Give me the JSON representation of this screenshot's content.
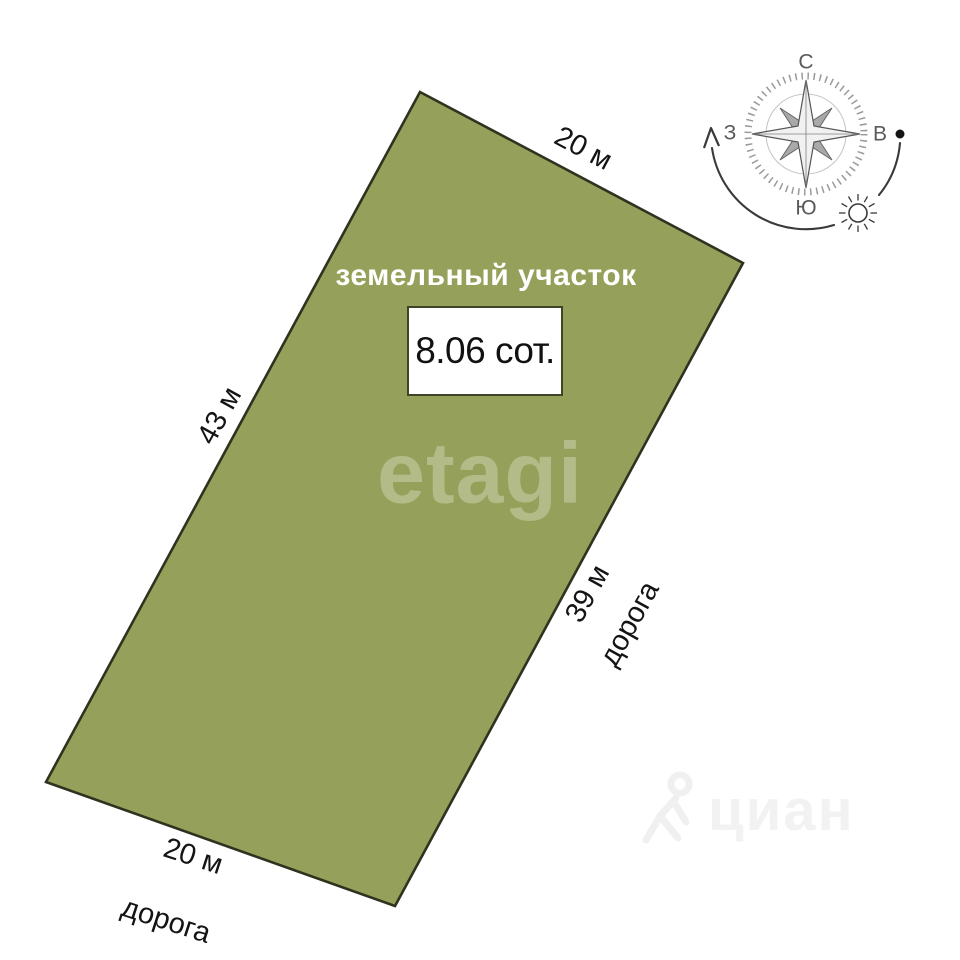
{
  "colors": {
    "plot_fill": "#95a15a",
    "plot_border": "#2e331f",
    "label_text": "#141414",
    "area_title_text": "#ffffff",
    "box_bg": "#ffffff",
    "box_border": "#3f4429",
    "compass_ink": "#3a3a3a",
    "compass_label": "#5a5a5a",
    "watermark_etagi": "#ffffff4a",
    "watermark_cian": "#f2f2f2"
  },
  "plot": {
    "title": "земельный участок",
    "area": "8.06 сот.",
    "dimensions": {
      "top": "20 м",
      "right": "39 м",
      "bottom": "20 м",
      "left": "43 м"
    },
    "roads": {
      "right": "дорога",
      "bottom": "дорога"
    }
  },
  "compass": {
    "north": "С",
    "east": "В",
    "south": "Ю",
    "west": "З"
  },
  "watermarks": {
    "center": "etagi",
    "bottom_right": "циан"
  }
}
